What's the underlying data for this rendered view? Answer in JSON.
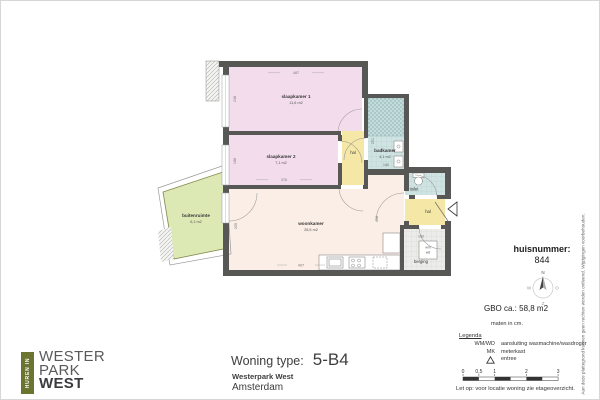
{
  "plan": {
    "rooms": {
      "slaapkamer1": {
        "label": "slaapkamer 1",
        "area": "11,6 m2"
      },
      "slaapkamer2": {
        "label": "slaapkamer 2",
        "area": "7,1 m2"
      },
      "woonkamer": {
        "label": "woonkamer",
        "area": "28,5 m2"
      },
      "badkamer": {
        "label": "badkamer",
        "area": "4,1 m2"
      },
      "buitenruimte": {
        "label": "buitenruimte",
        "area": "6,1 m2"
      },
      "hal_boven": {
        "label": "hal"
      },
      "hal_entree": {
        "label": "hal"
      },
      "toilet": {
        "label": "toilet"
      },
      "berging": {
        "label": "berging"
      }
    },
    "dims": {
      "slk1_w": "487",
      "slk1_d": "238",
      "slk2_w": "376",
      "slk2_d": "188",
      "bad_d": "251",
      "bad_w": "166",
      "woon_w": "407",
      "woon_d_links": "205",
      "woon_d_rechts": "408",
      "berging_w": "160"
    },
    "fixtures": {
      "wm": "wm",
      "wd": "wd"
    },
    "colors": {
      "bedroom": "#f3dded",
      "living": "#faeee6",
      "hal": "#f5e7a6",
      "wet": "#cfe3e2",
      "storage": "#ececea",
      "balcony": "#dde9b4",
      "wall": "#575756",
      "logo_green": "#6b7530"
    }
  },
  "info": {
    "huisnummer_label": "huisnummer:",
    "huisnummer": "844",
    "compass": {
      "n": "N",
      "e": "O",
      "s": "Z",
      "w": "W"
    },
    "gbo": "GBO ca.:  58,8 m2",
    "maten": "maten in cm.",
    "legend": {
      "title": "Legenda",
      "rows": [
        {
          "key": "WM/WD",
          "value": "aansluiting wasmachine/wasdroger"
        },
        {
          "key": "MK",
          "value": "meterkast"
        },
        {
          "key": "",
          "value": "entree",
          "symbol": "entree-triangle"
        }
      ]
    },
    "scalebar": {
      "labels": [
        "0",
        "0,5",
        "1",
        "2",
        "3"
      ]
    },
    "note": "Let op:  voor locatie woning zie etageoverzicht."
  },
  "footer": {
    "type_label": "Woning type:",
    "type_value": "5-B4",
    "project": "Westerpark West",
    "city": "Amsterdam"
  },
  "logo": {
    "vertical": "HUREN IN",
    "line1": "WESTER",
    "line2": "PARK",
    "line3": "WEST"
  },
  "disclaimer": "Aan deze plattegrond kunnen geen rechten worden ontleend. Wijzigingen voorbehouden."
}
